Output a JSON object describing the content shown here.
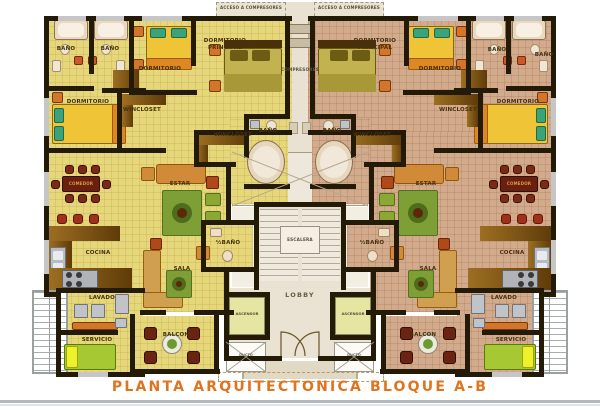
{
  "title": "PLANTA ARQUITECTONICA BLOQUE A-B",
  "colors": {
    "title_orange": "#e0731d",
    "left_unit_floor": "#e7d77b",
    "right_unit_floor": "#d2ab8d",
    "core_beige": "#e9e2d2",
    "wall_black": "#241a08"
  },
  "labels": {
    "bano": "BAÑO",
    "half_bano": "½BAÑO",
    "dormitorio": "DORMITORIO",
    "dormitorio_principal": "DORMITORIO PRINCIPAL",
    "wincloset": "WINCLOSET",
    "estar": "ESTAR",
    "comedor": "COMEDOR",
    "cocina": "COCINA",
    "sala": "SALA",
    "lavado": "LAVADO",
    "servicio": "SERVICIO",
    "balcon": "BALCON",
    "lobby": "LOBBY",
    "escalera": "ESCALERA",
    "ascensor": "ASCENSOR",
    "ducto": "DUCTO",
    "compresores": "COMPRESORES",
    "acceso_compresores": "ACCESO A COMPRESORES"
  }
}
